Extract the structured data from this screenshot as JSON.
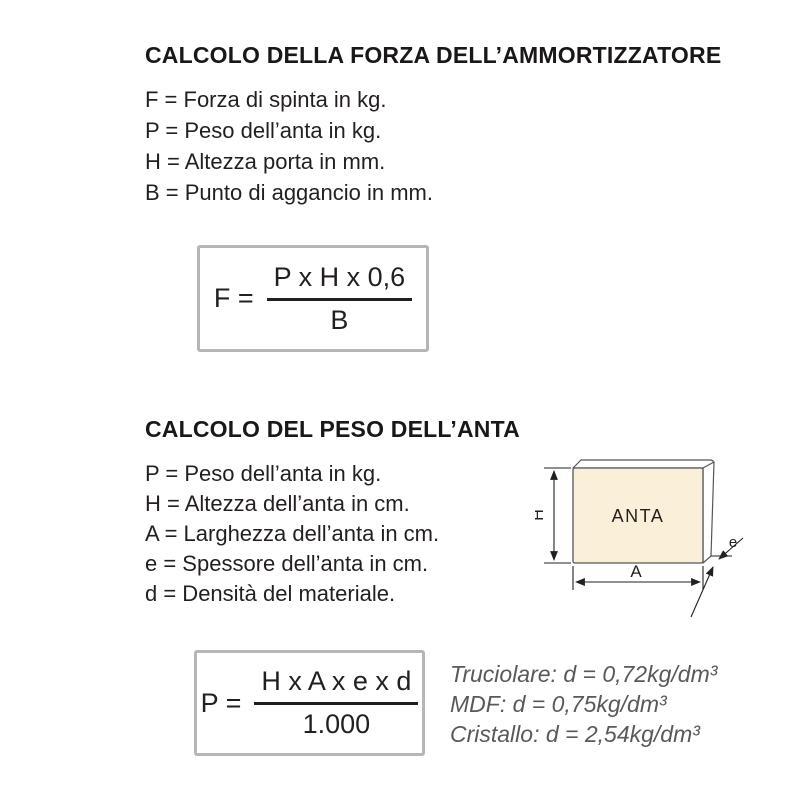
{
  "section_force": {
    "title": "CALCOLO DELLA FORZA DELL’AMMORTIZZATORE",
    "definitions": [
      "F = Forza di spinta in kg.",
      "P = Peso dell’anta in kg.",
      "H = Altezza porta in mm.",
      "B = Punto di aggancio in mm."
    ],
    "formula": {
      "lhs": "F =",
      "numerator": "P x H x 0,6",
      "denominator": "B"
    }
  },
  "section_weight": {
    "title": "CALCOLO DEL PESO DELL’ANTA",
    "definitions": [
      "P = Peso dell’anta in kg.",
      "H = Altezza dell’anta in cm.",
      "A = Larghezza dell’anta in cm.",
      "e = Spessore dell’anta in cm.",
      "d = Densità del materiale."
    ],
    "formula": {
      "lhs": "P =",
      "numerator": "H x A x e x d",
      "denominator": "1.000"
    },
    "densities": [
      "Truciolare: d = 0,72kg/dm³",
      "MDF: d = 0,75kg/dm³",
      "Cristallo: d = 2,54kg/dm³"
    ],
    "diagram": {
      "panel_label": "ANTA",
      "height_label": "H",
      "width_label": "A",
      "thickness_label": "e",
      "panel_fill": "#faf0da",
      "outline_color": "#55565a",
      "dimension_color": "#231f20"
    }
  },
  "colors": {
    "text": "#231f20",
    "muted_text": "#58595b",
    "box_border": "#b5b6b8",
    "background": "#ffffff"
  }
}
